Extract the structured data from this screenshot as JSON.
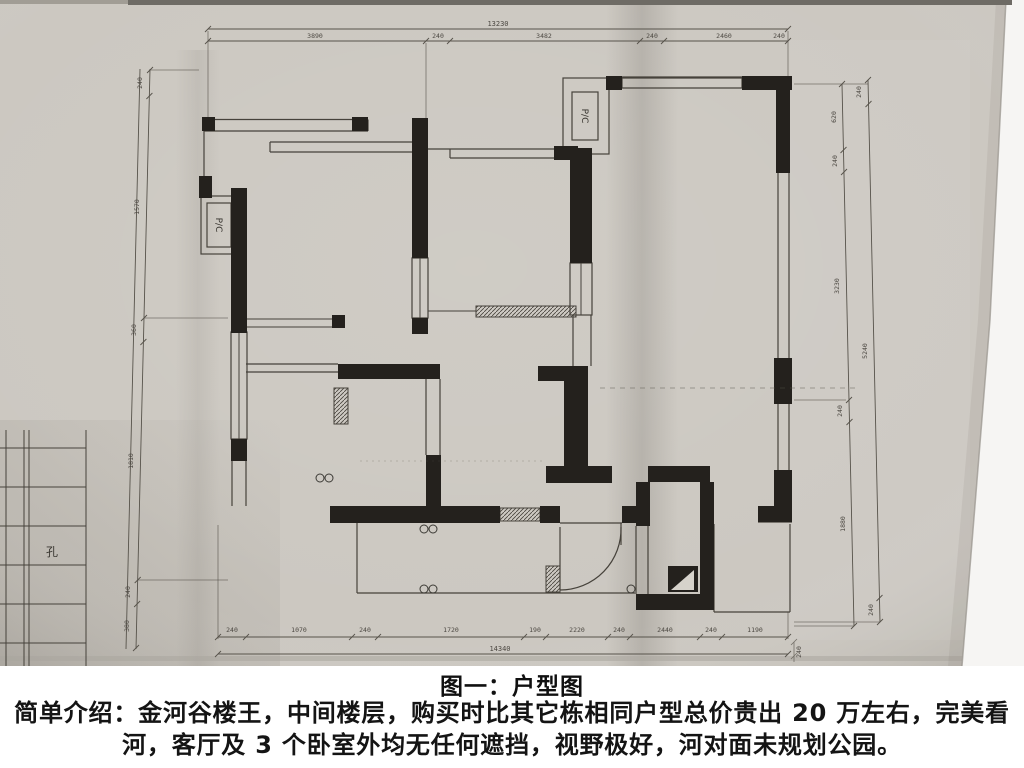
{
  "caption": {
    "title": "图一：户型图"
  },
  "intro": {
    "line1": "简单介绍：金河谷楼王，中间楼层，购买时比其它栋相同户型总价贵出 20 万左右，完美看",
    "line2": "河，客厅及 3 个卧室外均无任何遮挡，视野极好，河对面未规划公园。"
  },
  "plan": {
    "ac_label": "P/C",
    "table_label": "孔",
    "dims": {
      "top": {
        "total": "13230",
        "segments": [
          "3890",
          "240",
          "3482",
          "240",
          "2460",
          "240"
        ]
      },
      "bottom": {
        "total": "14340",
        "extra": "240",
        "segments": [
          "240",
          "1070",
          "240",
          "1720",
          "190",
          "2220",
          "240",
          "2440",
          "240",
          "1190"
        ]
      },
      "left": {
        "segments": [
          "240",
          "1570",
          "360",
          "1810",
          "240",
          "380"
        ]
      },
      "right_inner": {
        "segments": [
          "620",
          "240",
          "3230",
          "240",
          "1880"
        ]
      },
      "right_outer": {
        "segments": [
          "240",
          "5240",
          "240"
        ]
      }
    }
  },
  "colors": {
    "paper": "#ccc8c1",
    "wall": "#24211d",
    "ink": "#46423b",
    "text": "#141414"
  }
}
